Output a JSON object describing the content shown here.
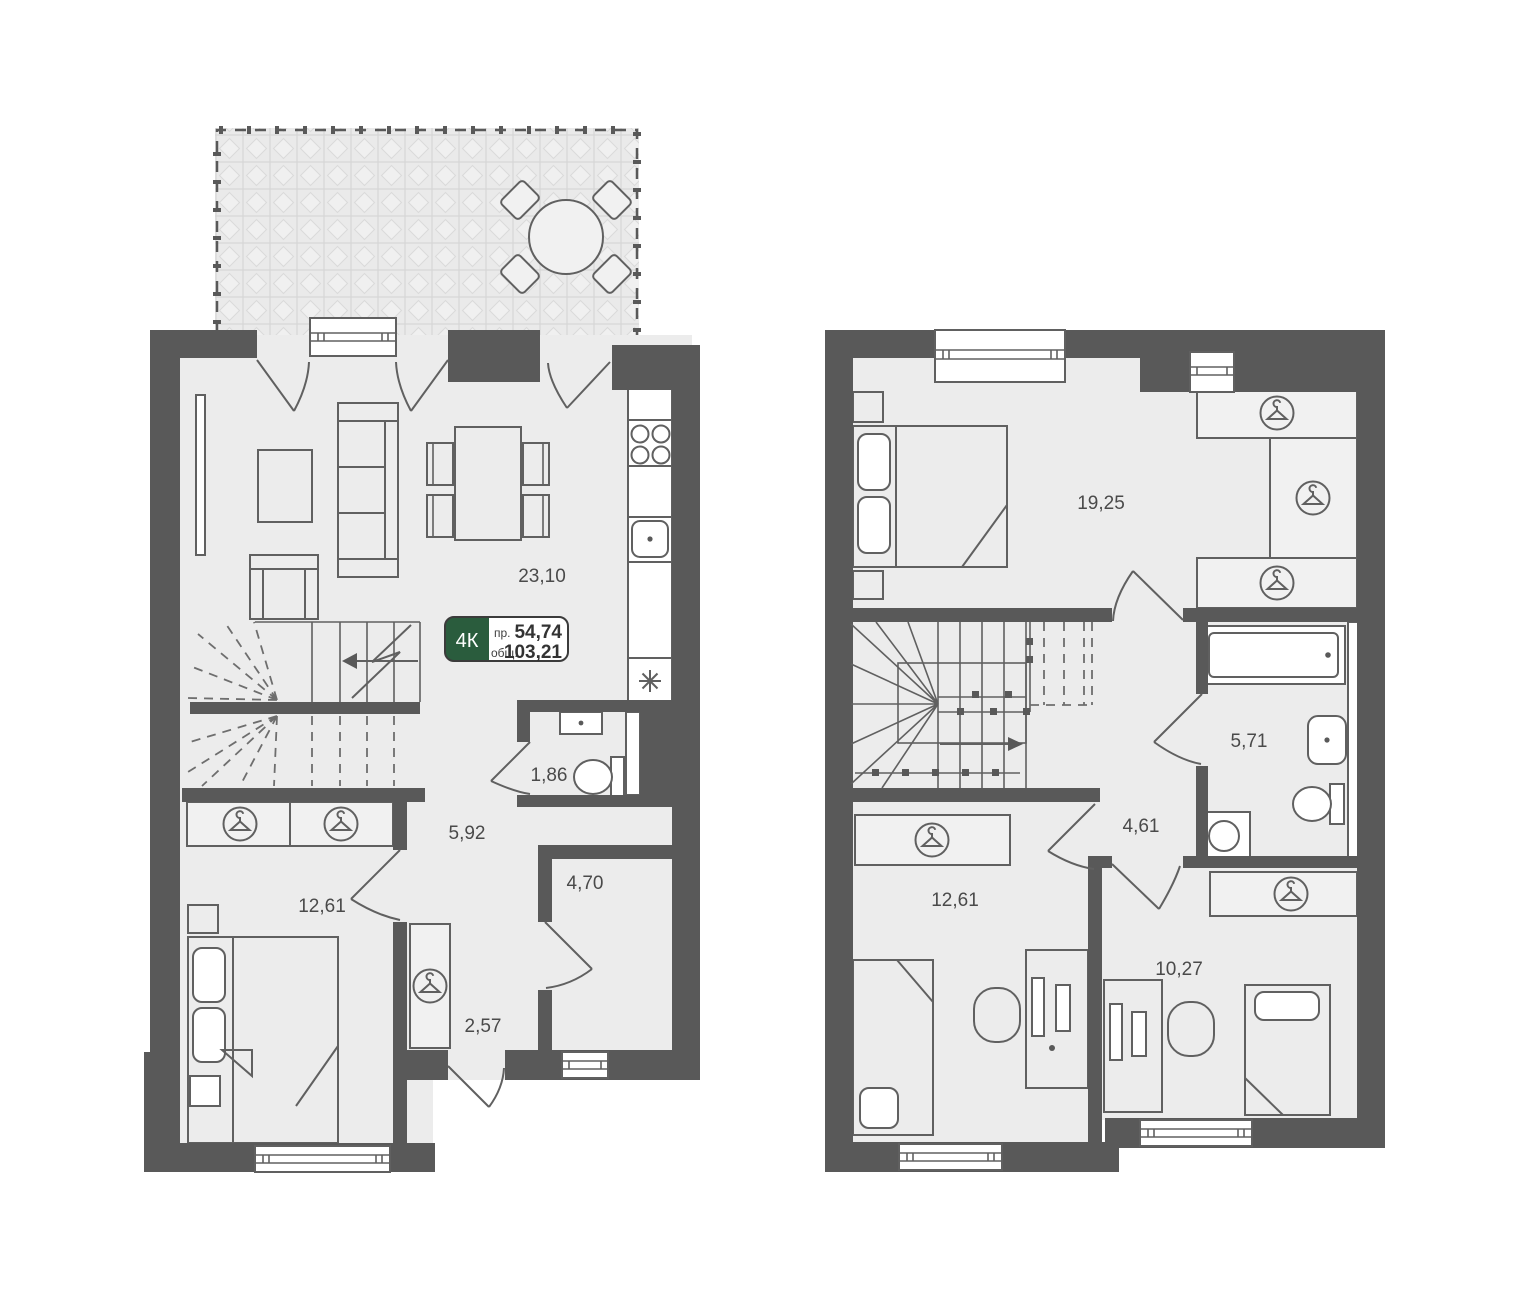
{
  "title": "План таунхауса 4К — два уровня",
  "badge": {
    "rooms_label": "4К",
    "pr_label": "пр.",
    "pr_value": "54,74",
    "total_label": "общ.",
    "total_value": "103,21"
  },
  "floor1": {
    "name": "first-floor",
    "rooms": [
      {
        "name": "kitchen-living-room",
        "area": "23,10"
      },
      {
        "name": "wc",
        "area": "1,86"
      },
      {
        "name": "hall",
        "area": "5,92"
      },
      {
        "name": "bedroom",
        "area": "12,61"
      },
      {
        "name": "storeroom",
        "area": "4,70"
      },
      {
        "name": "entry-hall",
        "area": "2,57"
      }
    ]
  },
  "floor2": {
    "name": "second-floor",
    "rooms": [
      {
        "name": "bedroom-master",
        "area": "19,25"
      },
      {
        "name": "bathroom",
        "area": "5,71"
      },
      {
        "name": "hall",
        "area": "4,61"
      },
      {
        "name": "bedroom-left",
        "area": "12,61"
      },
      {
        "name": "bedroom-right",
        "area": "10,27"
      }
    ]
  },
  "colors": {
    "wall": "#595959",
    "floor": "#ececec",
    "terrace_tile": "#eaeaea",
    "badge_green": "#2A5C3D",
    "label_text": "#4a4a4a",
    "background": "#ffffff"
  },
  "icons": [
    "clothes-hanger-icon",
    "stove-burners-icon",
    "kitchen-sink-icon",
    "boiler-asterisk-icon",
    "toilet-icon",
    "washbasin-icon",
    "bathtub-icon",
    "washing-machine-icon",
    "stairs-direction-arrow-icon",
    "terrace-table-icon"
  ]
}
